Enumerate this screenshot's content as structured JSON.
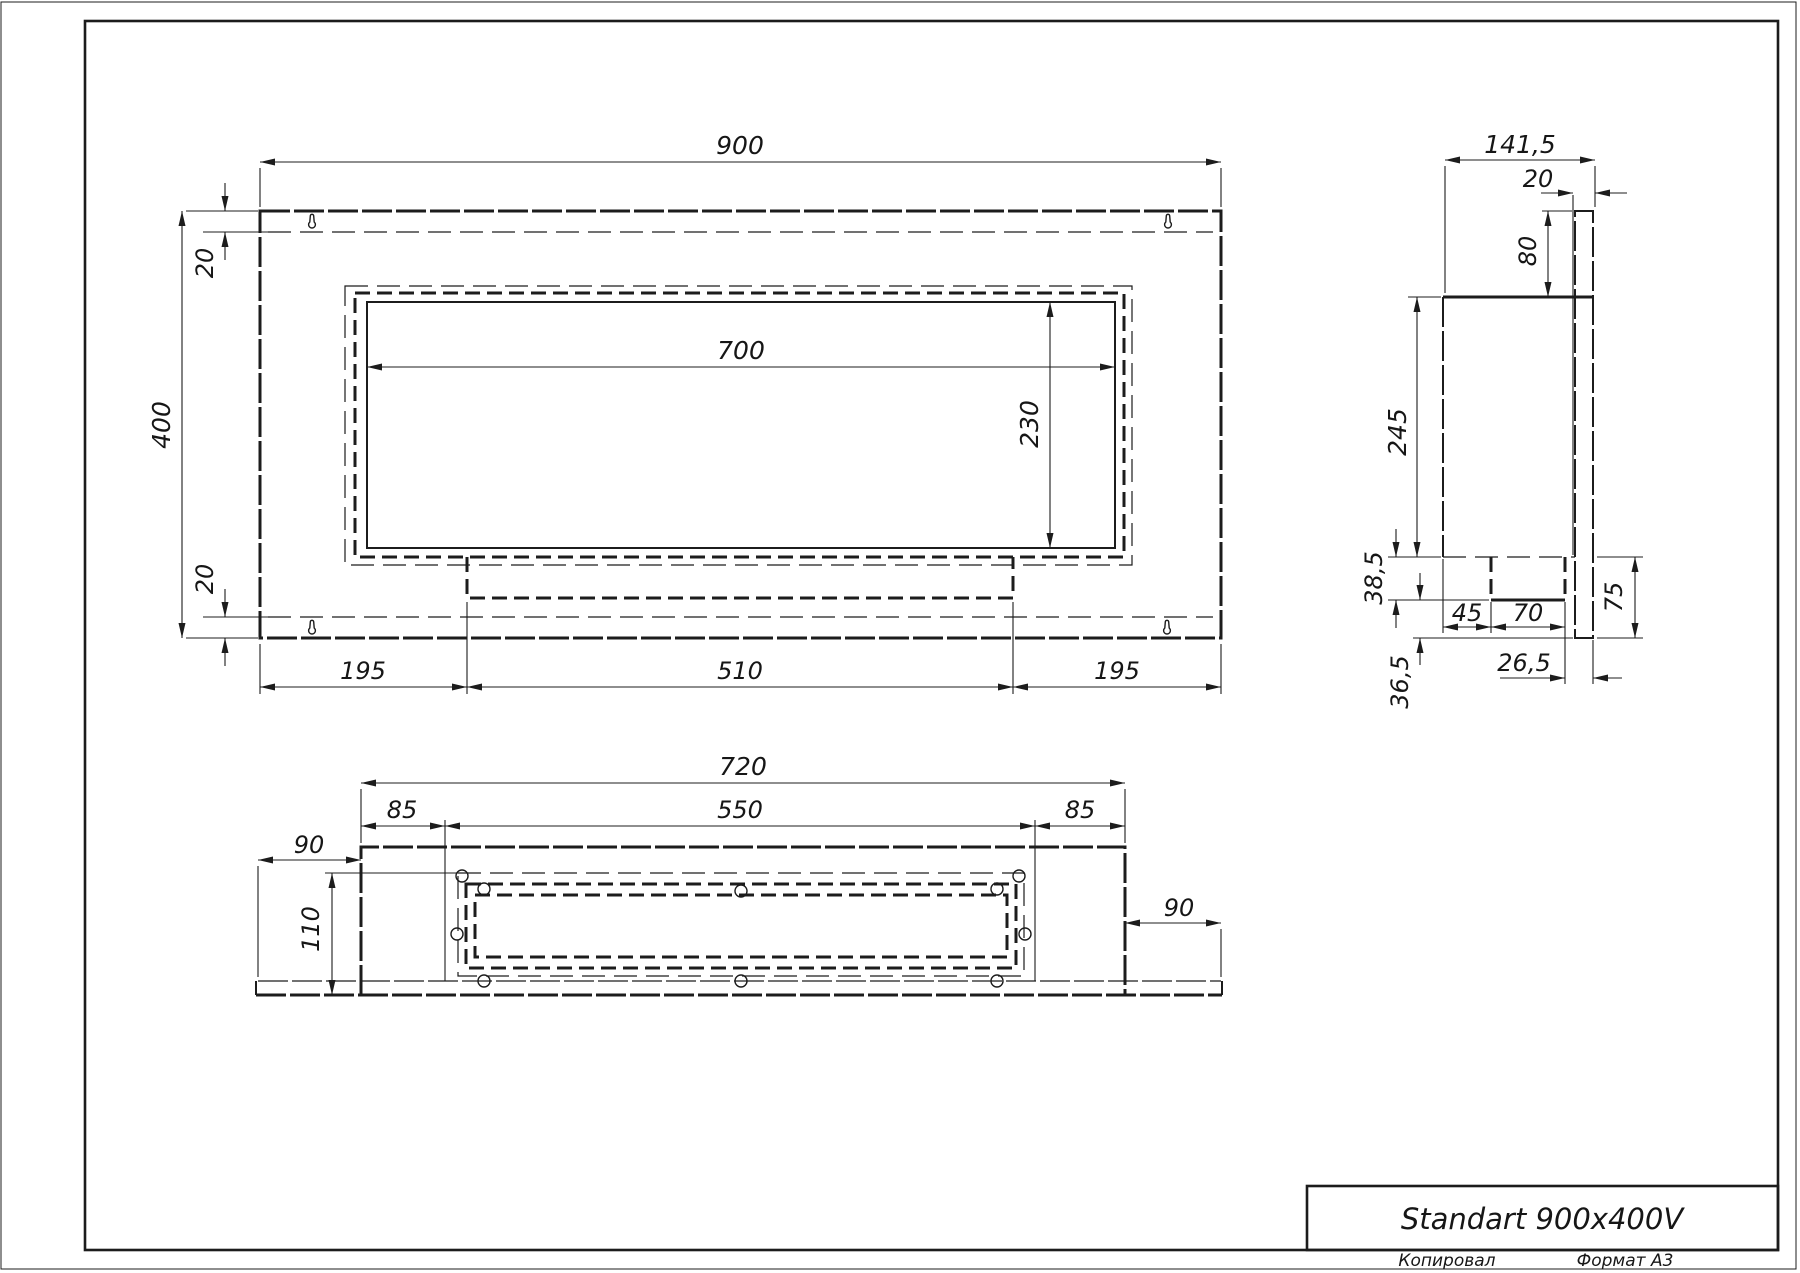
{
  "title_block": {
    "title": "Standart 900x400V",
    "copied_label": "Копировал",
    "format_label": "Формат А3"
  },
  "dims": {
    "front_width": "900",
    "front_height": "400",
    "front_top_offset": "20",
    "front_bottom_offset": "20",
    "window_width": "700",
    "window_height": "230",
    "front_left": "195",
    "front_center": "510",
    "front_right": "195",
    "side_depth": "141,5",
    "side_hook_offset": "20",
    "side_hook_height": "80",
    "side_body_height": "245",
    "side_tray_depth": "38,5",
    "side_tray_left": "45",
    "side_tray_width": "70",
    "side_plate_drop": "75",
    "side_tray_right": "26,5",
    "side_plate_tip": "36,5",
    "bottom_body_width": "720",
    "bottom_opening_width": "550",
    "bottom_flap_left": "85",
    "bottom_flap_right": "85",
    "bottom_plate_left": "90",
    "bottom_plate_right": "90",
    "bottom_depth": "110"
  }
}
